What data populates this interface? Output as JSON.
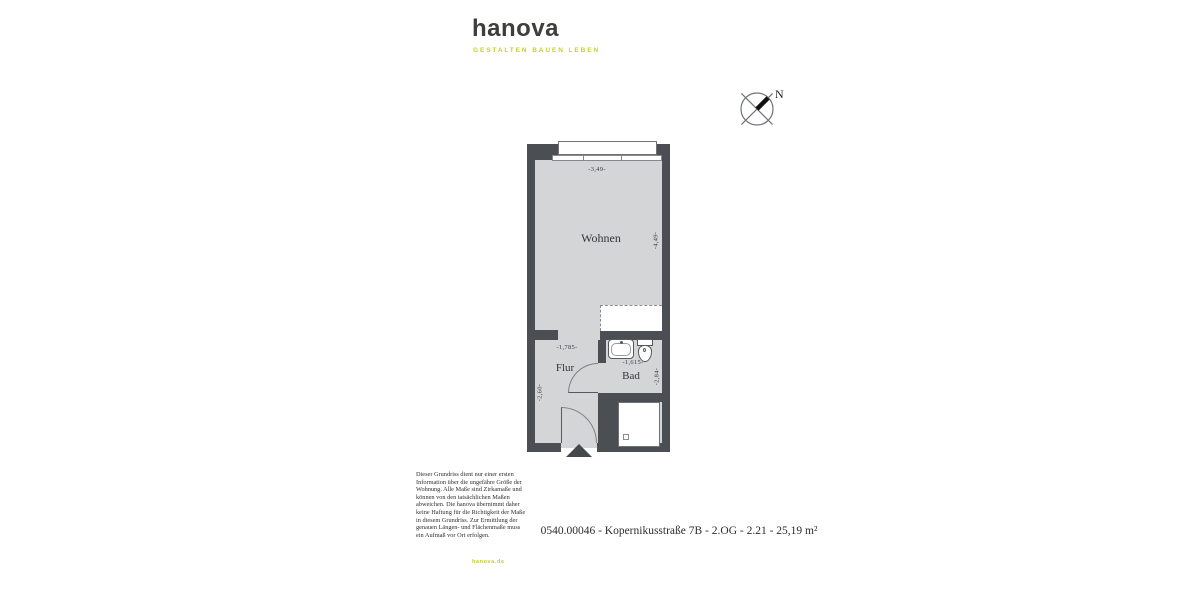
{
  "brand": {
    "logo": "hanova",
    "tagline": "GESTALTEN BAUEN LEBEN",
    "website": "hanova.de",
    "accent_color": "#c2d12e",
    "dark_color": "#3e3e3d"
  },
  "compass": {
    "north_label": "N"
  },
  "floorplan": {
    "rooms": [
      {
        "name": "Wohnen"
      },
      {
        "name": "Flur"
      },
      {
        "name": "Bad"
      }
    ],
    "dimensions": {
      "wohnen_width": "-3,49-",
      "wohnen_depth": "-4,49-",
      "flur_width": "-1,785-",
      "flur_depth": "-2,60-",
      "bad_width": "-1,615-",
      "bad_depth": "-2,84-"
    },
    "colors": {
      "wall": "#4b4e53",
      "floor": "#d4d5d7"
    }
  },
  "disclaimer": "Dieser Grundriss dient nur einer ersten\nInformation über die ungefähre Größe der\nWohnung. Alle Maße sind Zirkamaße und\nkönnen von den tatsächlichen Maßen\nabweichen. Die hanova übernimmt daher\nkeine Haftung für die Richtigkeit der Maße\nin diesem Grundriss. Zur Ermittlung der\ngenauen Längen- und Flächenmaße muss\nein Aufmaß vor Ort erfolgen.",
  "footer": {
    "address_line": "0540.00046 - Kopernikusstraße 7B - 2.OG - 2.21 - 25,19 m²"
  }
}
